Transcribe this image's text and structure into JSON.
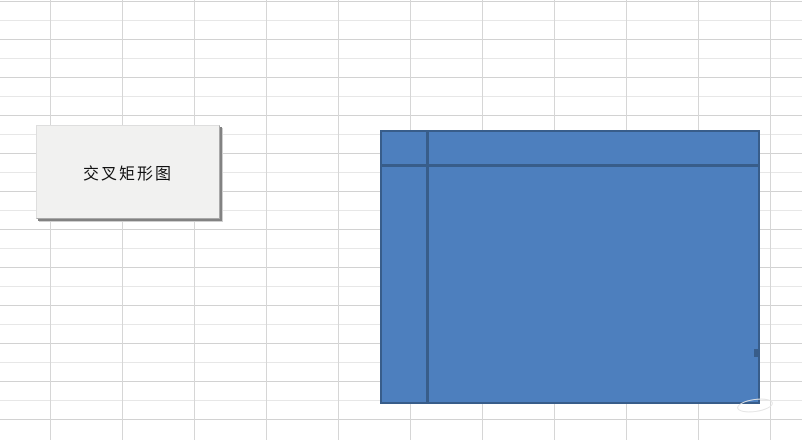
{
  "page": {
    "width": 802,
    "height": 440,
    "background_color": "#ffffff"
  },
  "worksheet": {
    "column_width_px": 72,
    "row_height_px": 19,
    "gridline_color": "#d6d6d6",
    "gridline_color_alt": "#e7e7e7"
  },
  "macro_button": {
    "label": "交叉矩形图",
    "face_color": "#f1f1f0",
    "shadow_color": "#828282",
    "text_color": "#111111",
    "x": 36,
    "y": 125,
    "width": 184,
    "height": 94
  },
  "shape": {
    "kind": "crossed-rectangles",
    "fill_color": "#4d7fbe",
    "border_color": "#385d8a",
    "x": 380,
    "y": 130,
    "width": 380,
    "height": 274,
    "vertical_divider_x": 427,
    "horizontal_divider_y": 165
  }
}
